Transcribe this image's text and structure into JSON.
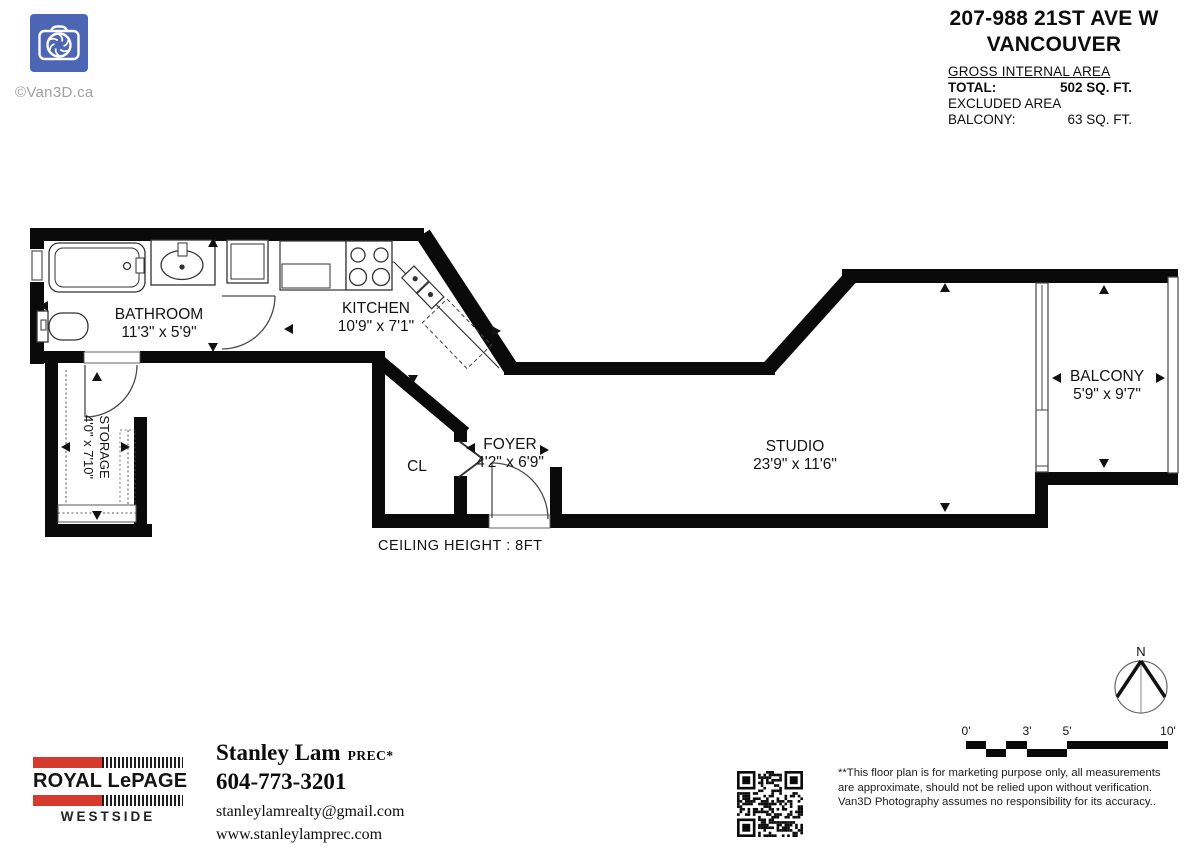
{
  "colors": {
    "logo_blue": "#4d66b3",
    "lepage_red": "#d63a2c"
  },
  "logo": {
    "icon": "camera-aperture",
    "copyright": "©Van3D.ca"
  },
  "header": {
    "address_line1": "207-988 21ST AVE W",
    "address_line2": "VANCOUVER",
    "area": {
      "heading": "GROSS INTERNAL AREA",
      "total_label": "TOTAL:",
      "total_value": "502 SQ. FT.",
      "excluded_label": "EXCLUDED AREA",
      "balcony_label": "BALCONY:",
      "balcony_value": "63 SQ. FT."
    }
  },
  "floorplan": {
    "ceiling_note": "CEILING HEIGHT : 8FT",
    "rooms": {
      "bathroom": {
        "name": "BATHROOM",
        "dims": "11'3\" x 5'9\""
      },
      "kitchen": {
        "name": "KITCHEN",
        "dims": "10'9\" x 7'1\""
      },
      "storage": {
        "name": "STORAGE",
        "dims": "4'0\" x 7'10\""
      },
      "closet": {
        "name": "CL"
      },
      "foyer": {
        "name": "FOYER",
        "dims": "4'2\" x 6'9\""
      },
      "studio": {
        "name": "STUDIO",
        "dims": "23'9\" x 11'6\""
      },
      "balcony": {
        "name": "BALCONY",
        "dims": "5'9\" x 9'7\""
      }
    }
  },
  "compass": {
    "north_label": "N"
  },
  "scalebar": {
    "labels": [
      "0'",
      "3'",
      "5'",
      "10'"
    ]
  },
  "footer": {
    "brokerage": {
      "title": "ROYAL LePAGE",
      "region": "WESTSIDE"
    },
    "agent": {
      "name": "Stanley Lam",
      "designation": "PREC*",
      "phone": "604-773-3201",
      "email": "stanleylamrealty@gmail.com",
      "website": "www.stanleylamprec.com"
    },
    "disclaimer": "**This floor plan is for marketing purpose only, all measurements are approximate, should not be relied upon without verification. Van3D Photography assumes no responsibility for its accuracy.."
  }
}
